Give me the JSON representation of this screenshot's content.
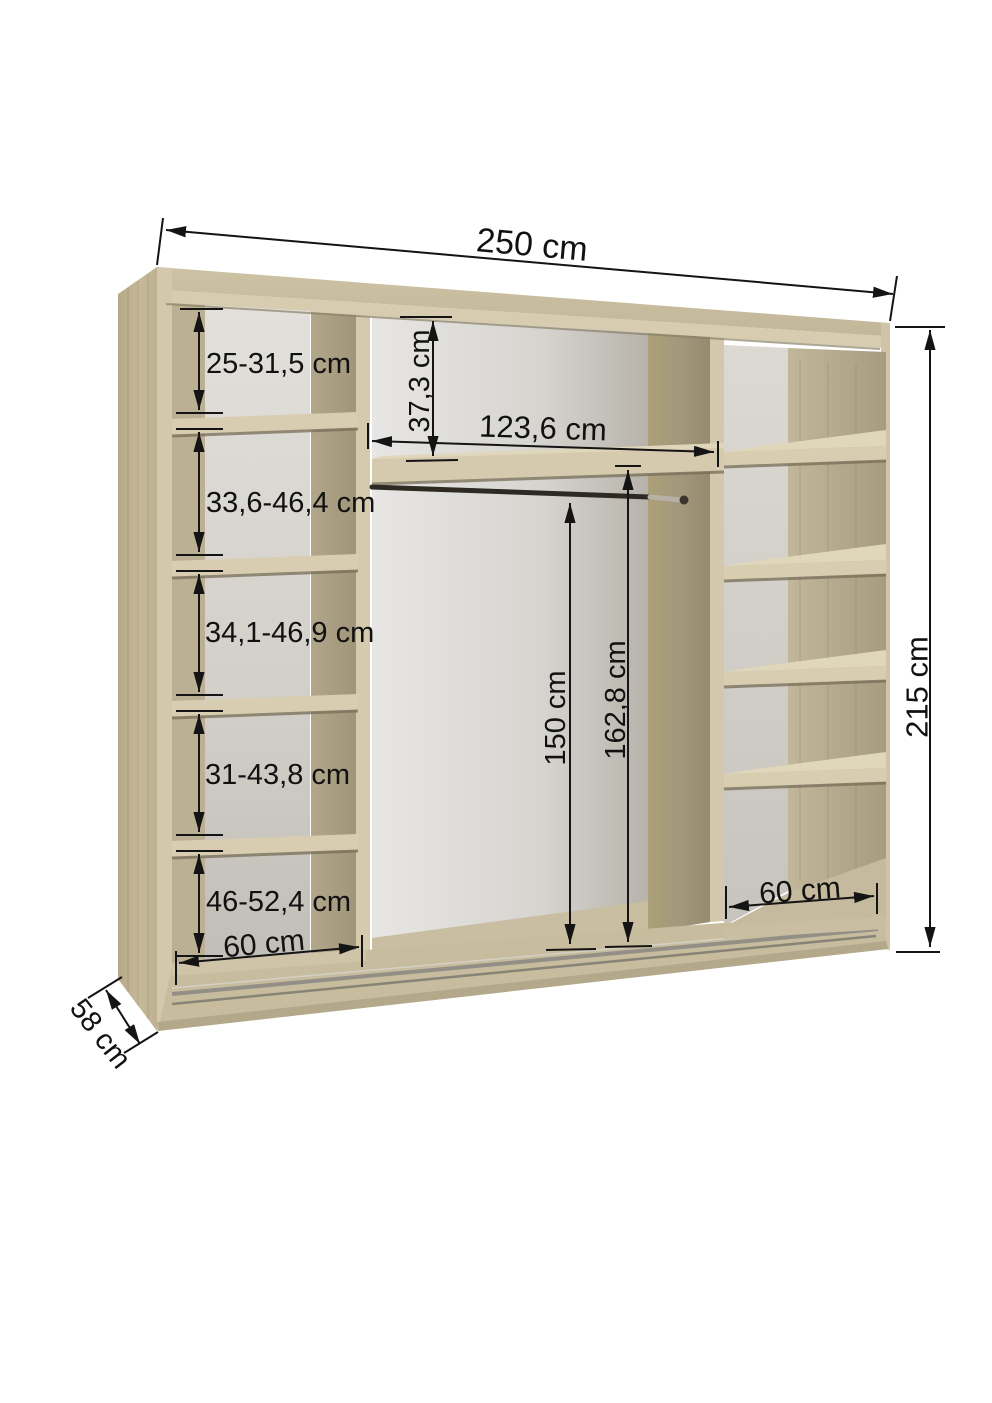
{
  "diagram": {
    "kind": "wardrobe-interior-dimension-drawing",
    "unit": "cm",
    "dims": {
      "total_width": "250 cm",
      "total_height": "215 cm",
      "depth": "58 cm",
      "left_column_width": "60 cm",
      "right_column_width": "60 cm",
      "middle_width": "123,6 cm",
      "top_shelf_drop": "37,3 cm",
      "rail_height": "150 cm",
      "middle_height": "162,8 cm",
      "left_shelf_1": "25-31,5 cm",
      "left_shelf_2": "33,6-46,4 cm",
      "left_shelf_3": "34,1-46,9 cm",
      "left_shelf_4": "31-43,8 cm",
      "left_shelf_5": "46-52,4 cm"
    },
    "colors": {
      "wood_edge": "#d6cbaf",
      "wood_top": "#c9bea0",
      "wood_side_dark": "#9c9176",
      "back_panel": "#e1dfda",
      "dimension_ink": "#141414",
      "rail_dark": "#2e2a23"
    }
  }
}
